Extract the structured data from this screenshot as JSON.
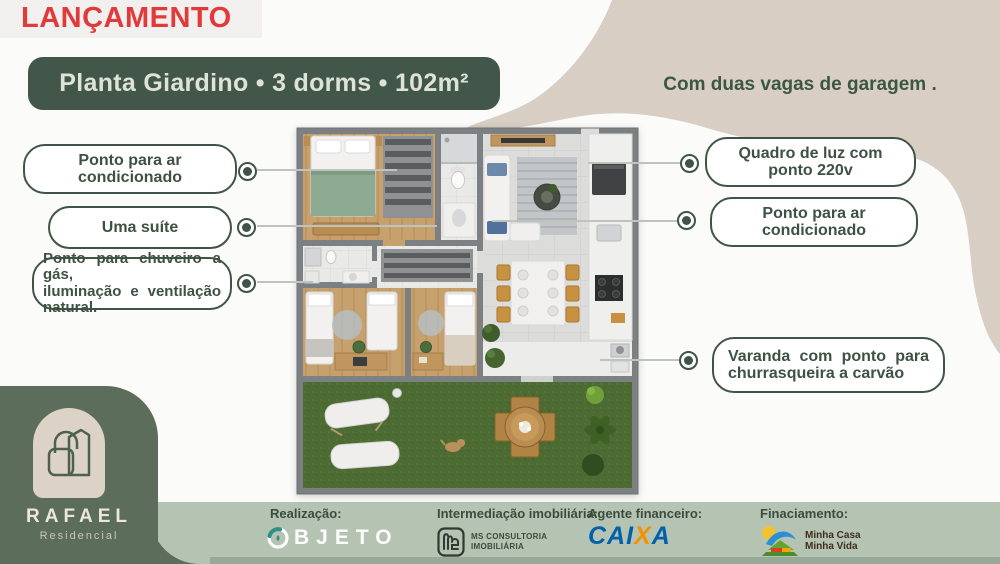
{
  "badge": {
    "label": "LANÇAMENTO"
  },
  "header": {
    "title": "Planta Giardino • 3 dorms • 102m²",
    "subtitle": "Com duas vagas de garagem ."
  },
  "callouts": {
    "left": [
      {
        "label": "Ponto para ar condicionado"
      },
      {
        "label": "Uma suíte"
      },
      {
        "lines": [
          "Ponto para chuveiro a gás,",
          "iluminação e ventilação",
          "natural."
        ]
      }
    ],
    "right": [
      {
        "label": "Quadro de luz com ponto 220v"
      },
      {
        "label": "Ponto para ar condicionado"
      },
      {
        "lines": [
          "Varanda com ponto para",
          "churrasqueira a carvão"
        ]
      }
    ]
  },
  "brand": {
    "name": "RAFAEL",
    "type": "Residencial"
  },
  "footer": {
    "realizacao": {
      "label": "Realização:",
      "logo_rest": "BJETO"
    },
    "intermediacao": {
      "label": "Intermediação imobiliária:",
      "logo_line1": "MS CONSULTORIA",
      "logo_line2": "IMOBILIÁRIA"
    },
    "agente": {
      "label": "Agente financeiro:",
      "logo_part1": "CAI",
      "logo_part2": "X",
      "logo_part3": "A"
    },
    "financiamento": {
      "label": "Finaciamento:",
      "logo_line1": "Minha Casa",
      "logo_line2": "Minha Vida"
    }
  },
  "colors": {
    "dark_green": "#3f5447",
    "title_green": "#42564a",
    "sage": "#b5c3b3",
    "beige": "#d8cec4",
    "red": "#e23a3a",
    "caixa_blue": "#0060a9",
    "caixa_orange": "#f39200"
  }
}
